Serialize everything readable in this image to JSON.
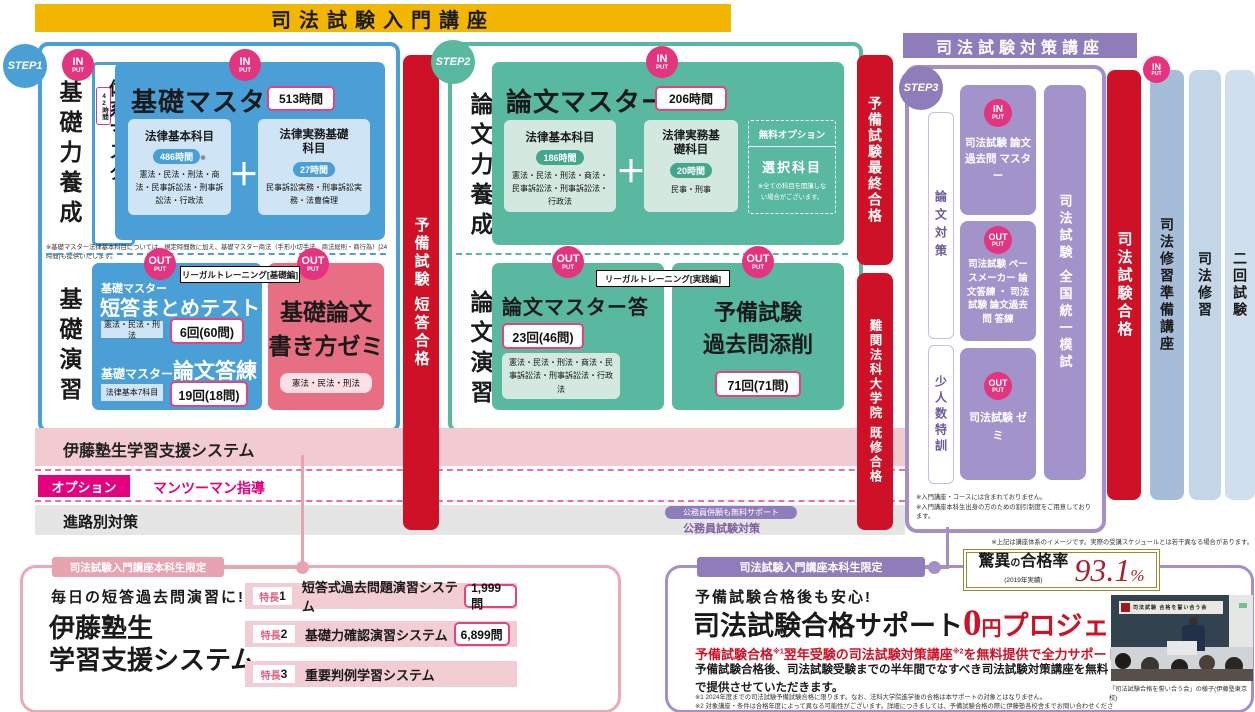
{
  "banner": {
    "intro": "司法試験入門講座",
    "taisaku": "司法試験対策講座"
  },
  "steps": {
    "s1": "STEP1",
    "s2": "STEP2",
    "s3": "STEP3"
  },
  "io": {
    "in": "IN",
    "out": "OUT",
    "put": "PUT"
  },
  "labels": {
    "plus": "＋"
  },
  "colors": {
    "yellow": "#f2b500",
    "blue": "#4aa0d6",
    "teal": "#58b8a0",
    "magenta": "#e4007f",
    "pink_circle": "#e4337f",
    "red": "#ce1126",
    "purple": "#8f7cba",
    "purple_box": "#a294ca",
    "pink_box": "#e76e83",
    "gold": "#9a8a30",
    "rate_red": "#a9222e"
  },
  "step1": {
    "phase_top": "基礎力養成",
    "phase_bottom": "基礎演習",
    "taikei_title": "体系マスター",
    "taikei_hours": "42時間",
    "kiso_title": "基礎マスター",
    "kiso_hours": "513時間",
    "kihon_title": "法律基本科目",
    "kihon_hours": "486時間",
    "kihon_note_mark": "※",
    "kihon_subjects": "憲法・民法・刑法・商法・民事訴訟法・刑事訴訟法・行政法",
    "jitsumu_title": "法律実務基礎科目",
    "jitsumu_hours": "27時間",
    "jitsumu_subjects": "民事訴訟実務・刑事訴訟実務・法曹倫理",
    "footnote": "※基礎マスター法律基本科目については、規定時間数に加え、基礎マスター商法（手形小切手法、商法総則・商行為）[24時間]も提供いたします。",
    "legal_training": "リーガルトレーニング[基礎編]",
    "tanto_pre": "基礎マスター",
    "tanto_title": "短答まとめテスト",
    "tanto_subjects": "憲法・民法・刑法",
    "tanto_count": "6回(60問)",
    "toren_pre": "基礎マスター",
    "toren_title": "論文答練",
    "toren_subjects": "法律基本7科目",
    "toren_count": "19回(18問)",
    "zemi_line1": "基礎論文",
    "zemi_line2": "書き方ゼミ",
    "zemi_subjects": "憲法・民法・刑法"
  },
  "step2": {
    "phase_top": "論文力養成",
    "phase_bottom": "論文演習",
    "ronbun_title": "論文マスター",
    "ronbun_hours": "206時間",
    "kihon_title": "法律基本科目",
    "kihon_hours": "186時間",
    "kihon_subjects": "憲法・民法・刑法・商法・民事訴訟法・刑事訴訟法・行政法",
    "jitsumu_title": "法律実務基礎科目",
    "jitsumu_hours": "20時間",
    "jitsumu_subjects": "民事・刑事",
    "option_label": "無料オプション",
    "option_title": "選択科目",
    "option_note": "※全ての科目を開講しない場合がございます。",
    "legal_training": "リーガルトレーニング[実践編]",
    "toren_title": "論文マスター答練",
    "toren_count": "23回(46問)",
    "toren_subjects": "憲法・民法・刑法・商法・民事訴訟法・刑事訴訟法・行政法",
    "kakomon_line1": "予備試験",
    "kakomon_line2": "過去問添削",
    "kakomon_count": "71回(71問)"
  },
  "bars": {
    "tanto_goukaku": "予備試験 短答合格",
    "saishu_goukaku": "予備試験最終合格",
    "lawschool_goukaku": "難関法科大学院 既修合格",
    "shihou_goukaku": "司法試験合格",
    "shushu_junbi": "司法修習準備講座",
    "shushu": "司法修習",
    "nikai_shiken": "二回試験"
  },
  "rows": {
    "support_system": "伊藤塾生学習支援システム",
    "option_badge": "オプション",
    "man_to_man": "マンツーマン指導",
    "shinro": "進路別対策",
    "koumuin_pill": "公務員併願も無料サポート",
    "koumuin": "公務員試験対策"
  },
  "step3": {
    "side_top": "論文対策",
    "side_bottom": "少人数特訓",
    "box1": "司法試験 論文過去問 マスター",
    "box2": "司法試験 ペースメーカー 論文答練 ・ 司法試験 論文過去問 答練",
    "box3": "司法試験 ゼミ",
    "mock_exam": "司法試験 全国統一模試",
    "note1": "※入門講座・コースには含まれておりません。",
    "note2": "※入門講座本科生出身の方のための割引制度をご用意しております。",
    "outer_note": "※上記は講座体系のイメージです。実際の受講スケジュールとは若干異なる場合があります。"
  },
  "bottom_left": {
    "tab": "司法試験入門講座本科生限定",
    "lead": "毎日の短答過去問演習に!",
    "title_line1": "伊藤塾生",
    "title_line2": "学習支援システム",
    "feature_label": "特長",
    "features": [
      {
        "num": "1",
        "title": "短答式過去問題演習システム",
        "count": "1,999問"
      },
      {
        "num": "2",
        "title": "基礎力確認演習システム",
        "count": "6,899問"
      },
      {
        "num": "3",
        "title": "重要判例学習システム",
        "count": ""
      }
    ]
  },
  "bottom_right": {
    "tab": "司法試験入門講座本科生限定",
    "rate_label_1": "驚異",
    "rate_label_no": "の",
    "rate_label_2": "合格率",
    "rate_year": "(2019年実績)",
    "rate_value": "93.1",
    "rate_percent": "%",
    "lead": "予備試験合格後も安心!",
    "title_black": "司法試験合格サポート",
    "title_zero": "0",
    "title_yen": "円",
    "title_project": "プロジェクト",
    "red_seg1": "予備試験合格",
    "red_sup1": "※1",
    "red_seg2": "翌年受験の司法試験対策講座",
    "red_sup2": "※2",
    "red_seg3": "を無料提供で全力サポートします。",
    "body": "予備試験合格後、司法試験受験までの半年間でなすべき司法試験対策講座を無料で提供させていただきます。",
    "note1": "※1 2024年度までの司法試験予備試験合格に限ります。なお、法科大学院進学後の合格は本サポートの対象とはなりません。",
    "note2": "※2 対象講座・条件は合格年度によって異なる可能性がございます。詳細につきましては、予備試験合格の際に伊藤塾各校舎までお問い合わせください。",
    "photo_board_text": "司法試験 合格を誓い合う会",
    "photo_caption": "「司法試験合格を誓い合う会」の様子(伊藤塾東京校)"
  }
}
